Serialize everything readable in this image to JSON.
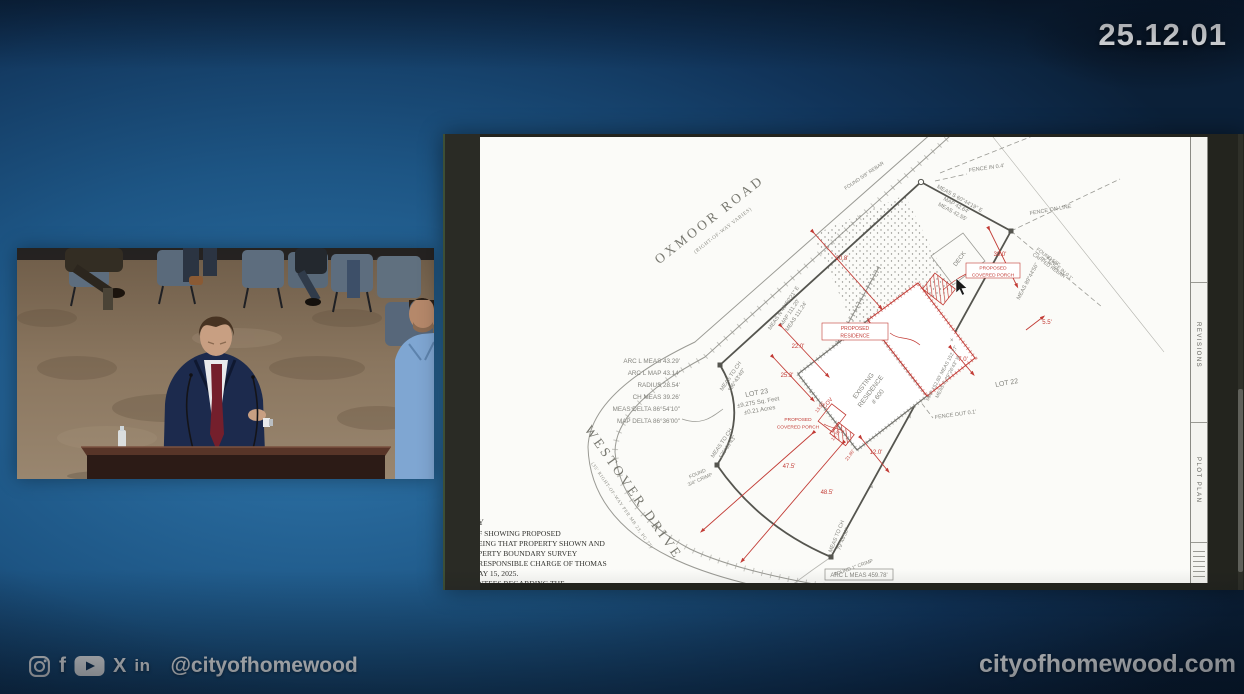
{
  "overlay": {
    "date": "25.12.01",
    "handle": "@cityofhomewood",
    "website": "cityofhomewood.com",
    "facebook_glyph": "f",
    "x_glyph": "X",
    "linkedin_glyph": "in"
  },
  "survey": {
    "road_top": "OXMOOR ROAD",
    "road_top_sub": "(RIGHT-OF-WAY VARIES)",
    "road_left": "WESTOVER DRIVE",
    "road_left_sub": "(35' RIGHT-OF-WAY PER MB 23, PG 77)",
    "lot": [
      "LOT 23",
      "±9,275 Sq. Feet",
      "±0.21 Acres"
    ],
    "lot_adjacent": "LOT 22",
    "curve_table": [
      "ARC L MEAS 43.29'",
      "ARC L MAP 43.14'",
      "RADIUS 28.54'",
      "CH MEAS 39.26'",
      "MEAS DELTA 86°54'10\"",
      "MAP DELTA 86°36'00\""
    ],
    "bearing_ab": [
      "MEAS S 60°44'19\" E",
      "MAP 42.64'",
      "MEAS 42.55'"
    ],
    "bearing_right": [
      "MEAS 89°44'56\"",
      "MAP 152.80'  MEAS 152.27'",
      "MEAS S 29°26'43\" W"
    ],
    "bearing_nw": [
      "MEAS N 46°50'21\" E",
      "MAP 111.20'",
      "MEAS 111.24'"
    ],
    "meas_to_ch_1": [
      "MEAS TO CH",
      "136°43'49\""
    ],
    "meas_to_ch_2": [
      "MEAS TO CH",
      "126°09'43\""
    ],
    "meas_to_ch_3": [
      "MEAS TO CH",
      "79°46'50\""
    ],
    "arc_bottom": "ARC L MEAS 459.78'",
    "fence": [
      "FENCE IN 0.4'",
      "FENCE ON LINE",
      "FENCE IN 0.1'",
      "FENCE OUT 0.1'"
    ],
    "monuments": [
      "FOUND 5/8\" REBAR",
      "FOUND 5/8\"",
      "CAPPED REBAR",
      "FOUND",
      "3/4\" CRIMP",
      "FOUND 1\" CRIMP"
    ],
    "dims": [
      "20.8'",
      "39.0'",
      "5.5'",
      "22.0'",
      "25.3'",
      "7.0'",
      "12.0'",
      "47.5'",
      "48.5'"
    ],
    "small_dims": [
      "13.55'",
      "13.70'",
      "21.80'"
    ],
    "existing": [
      "EXISTING",
      "RESIDENCE",
      "# 600"
    ],
    "proposed": [
      "PROPOSED",
      "RESIDENCE"
    ],
    "porch": [
      "PROPOSED",
      "COVERED PORCH"
    ],
    "deck": "DECK",
    "cov": "COV",
    "x_mark": "×",
    "cert_lines": [
      "Y",
      "F SHOWING PROPOSED",
      "EING THAT PROPERTY SHOWN AND",
      "PERTY BOUNDARY SURVEY",
      "RESPONSIBLE CHARGE OF THOMAS",
      "AY 15, 2025.",
      "NTEES REGARDING THE"
    ],
    "title_block": {
      "revisions": "REVISIONS",
      "plot_plan": "PLOT PLAN"
    }
  },
  "colors": {
    "accent_red": "#c23b35",
    "line_gray": "#9a9a94",
    "boundary": "#55554f",
    "bg_blue": "#1d5584"
  }
}
